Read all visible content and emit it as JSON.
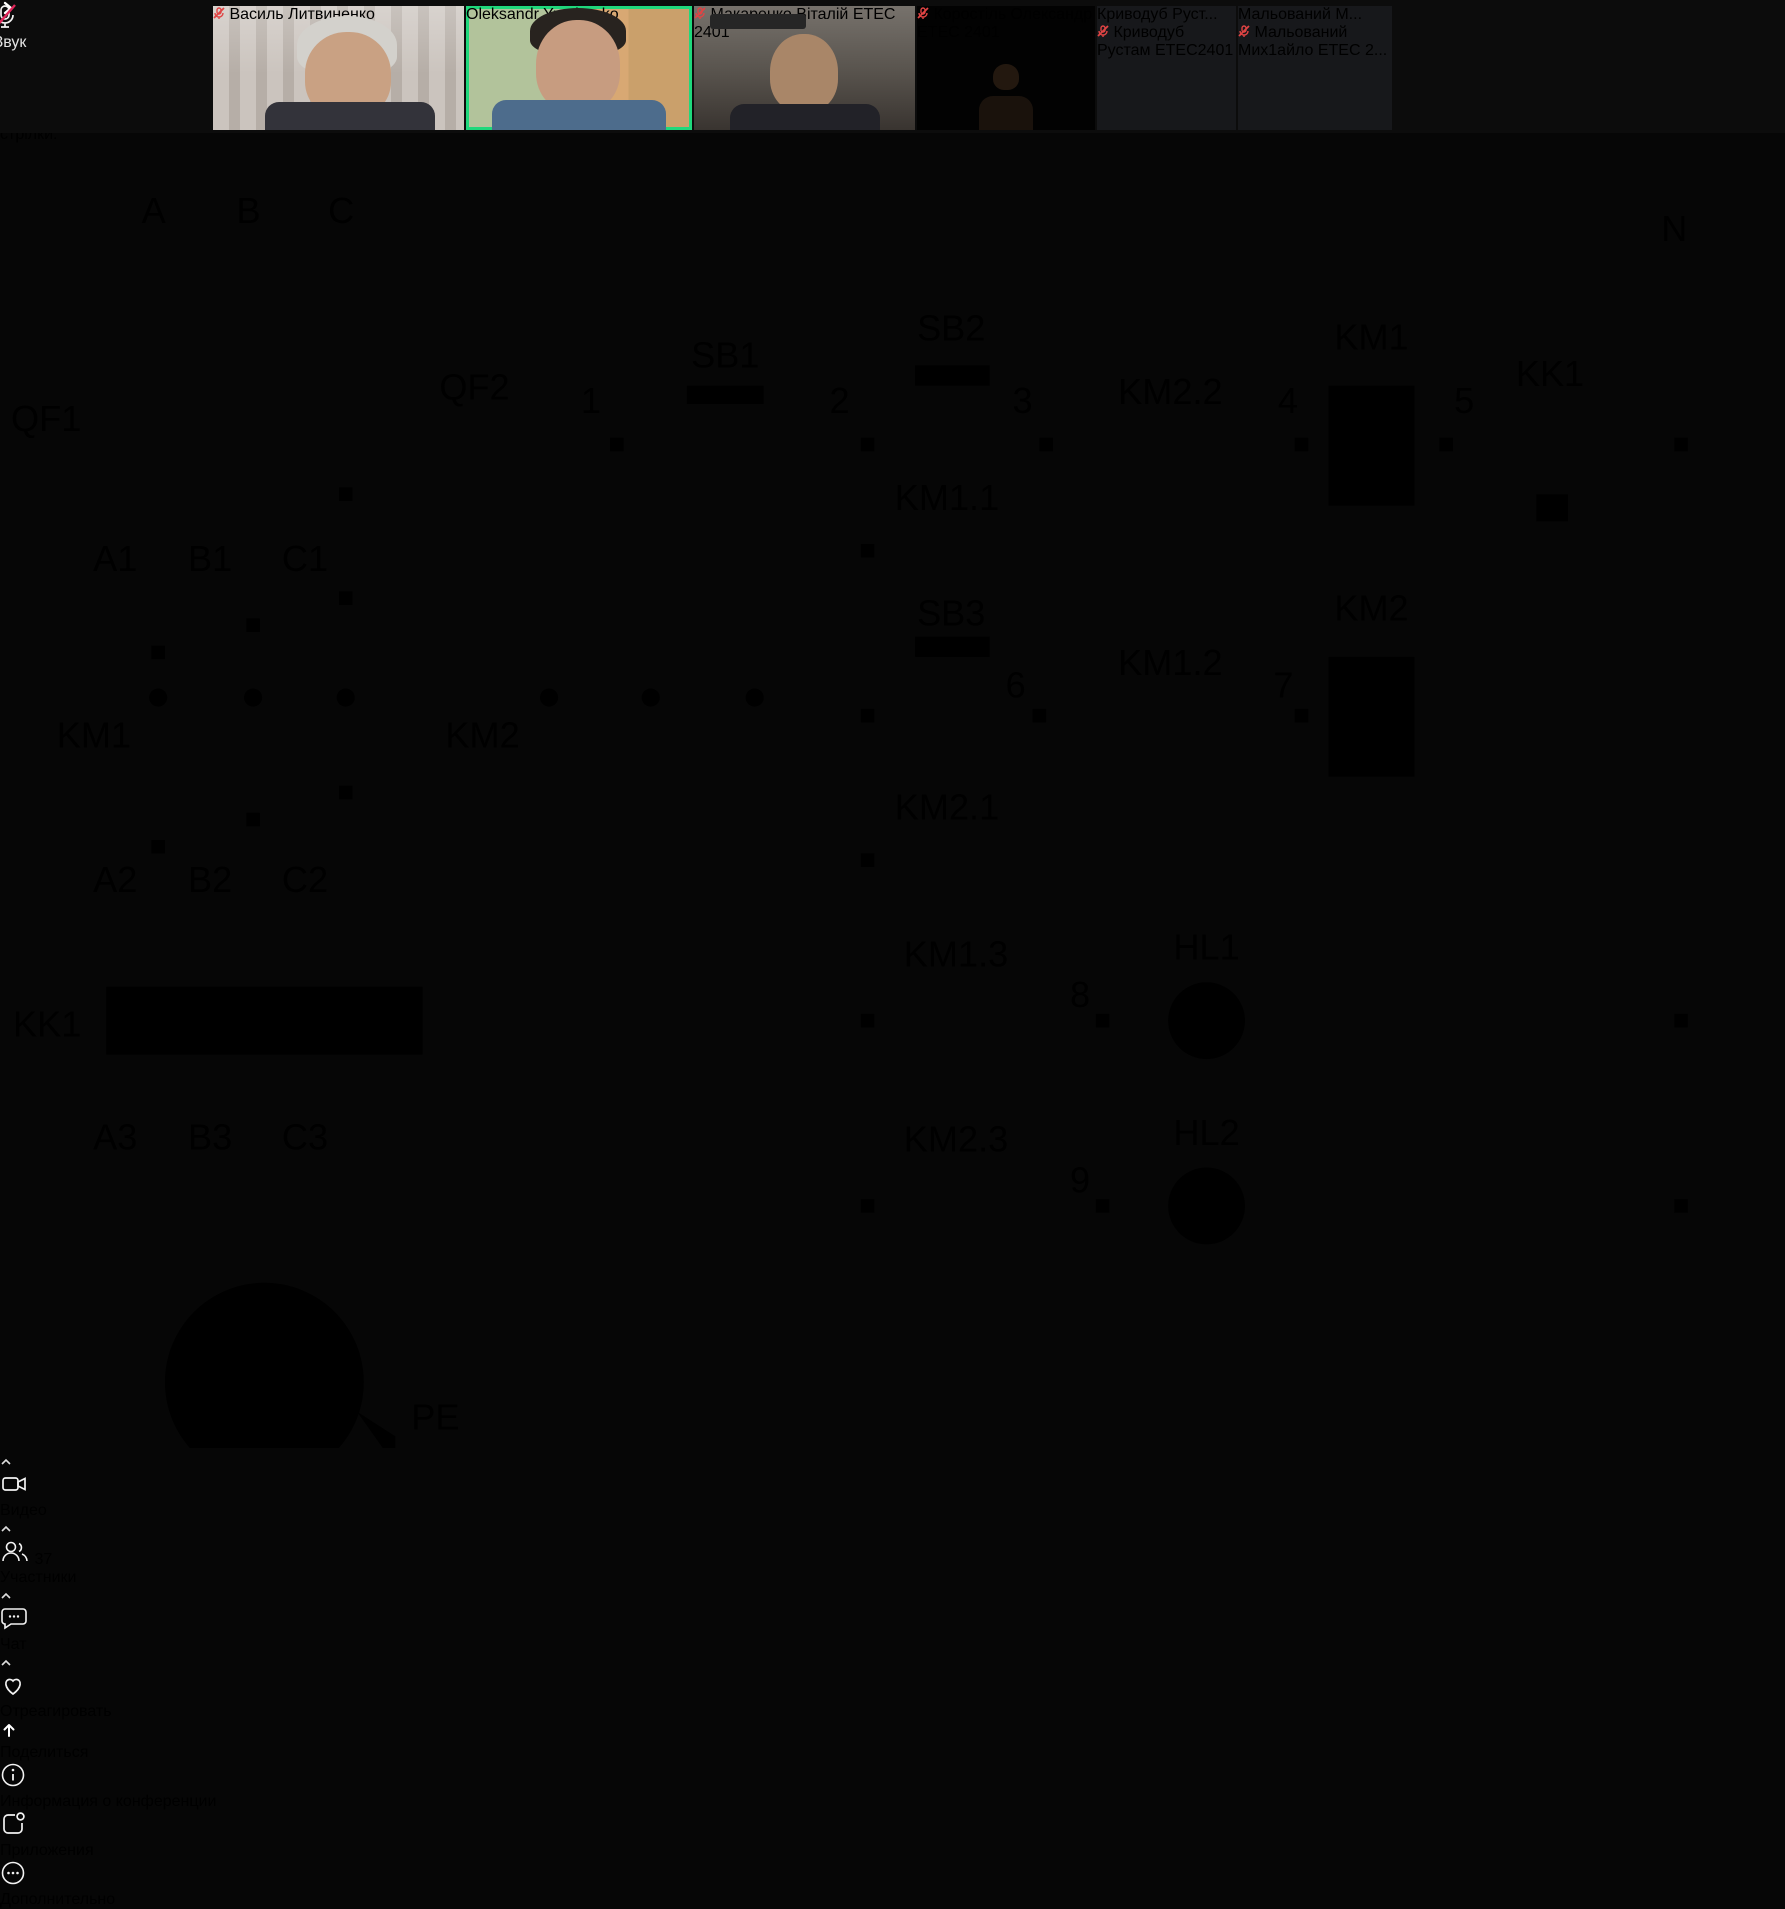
{
  "participants_strip": {
    "tiles": [
      {
        "name": "Василь Литвиненко",
        "muted": true
      },
      {
        "name": "Oleksandr Yurchenko",
        "muted": false,
        "active": true
      },
      {
        "name": "Макаренко Віталій ЕТЕС 2401",
        "muted": true
      },
      {
        "name": "Коростіль Олександр ЕТЕС 2401",
        "muted": true
      },
      {
        "name": "Криводуб Рустам ЕТЕС2401",
        "display_name": "Криводуб  Руст...",
        "muted": true
      },
      {
        "name": "Мальований Мих1айло ЕТЕС 2...",
        "display_name": "Мальований  М...",
        "muted": true
      }
    ]
  },
  "slide": {
    "title_line1": "Схема запуску електричного двигуна на",
    "title_line2": "реверсивний режим роботи",
    "body_lines": [
      "Схема реверсивного запуску",
      "електричного двигуна дає змогу",
      "працювати електричному двигуну з",
      "обертанням валу як за часовою",
      "стрілкою, так і проти часової",
      "стрілки."
    ],
    "diagram": {
      "wire_color": "#2a2ad4",
      "labels": {
        "a": "A",
        "b": "B",
        "c": "C",
        "qf1": "QF1",
        "qf2": "QF2",
        "a1": "A1",
        "b1": "B1",
        "c1": "C1",
        "km1_main": "KM1",
        "km2_main": "KM2",
        "a2": "A2",
        "b2": "B2",
        "c2": "C2",
        "kk1_main": "KK1",
        "a3": "A3",
        "b3": "B3",
        "c3": "C3",
        "motor": "M",
        "pe": "PE",
        "n": "N",
        "sb1": "SB1",
        "sb2": "SB2",
        "sb3": "SB3",
        "km1_1": "KM1.1",
        "km2_1": "KM2.1",
        "km2_2": "KM2.2",
        "km1_2": "KM1.2",
        "km1_3": "KM1.3",
        "km2_3": "KM2.3",
        "km1_coil": "KM1",
        "km2_coil": "KM2",
        "kk1_contact": "KK1",
        "hl1": "HL1",
        "hl2": "HL2",
        "num1": "1",
        "num2": "2",
        "num3": "3",
        "num4": "4",
        "num5": "5",
        "num6": "6",
        "num7": "7",
        "num8": "8",
        "num9": "9"
      }
    }
  },
  "toolbar": {
    "audio": {
      "label": "Звук"
    },
    "video": {
      "label": "Видео"
    },
    "participants": {
      "label": "Участники",
      "count": "37"
    },
    "chat": {
      "label": "Чат"
    },
    "react": {
      "label": "Отреагировать"
    },
    "share": {
      "label": "Поделиться"
    },
    "info": {
      "label": "Информация о конференции"
    },
    "apps": {
      "label": "Приложения"
    },
    "more": {
      "label": "Дополнительно"
    }
  }
}
